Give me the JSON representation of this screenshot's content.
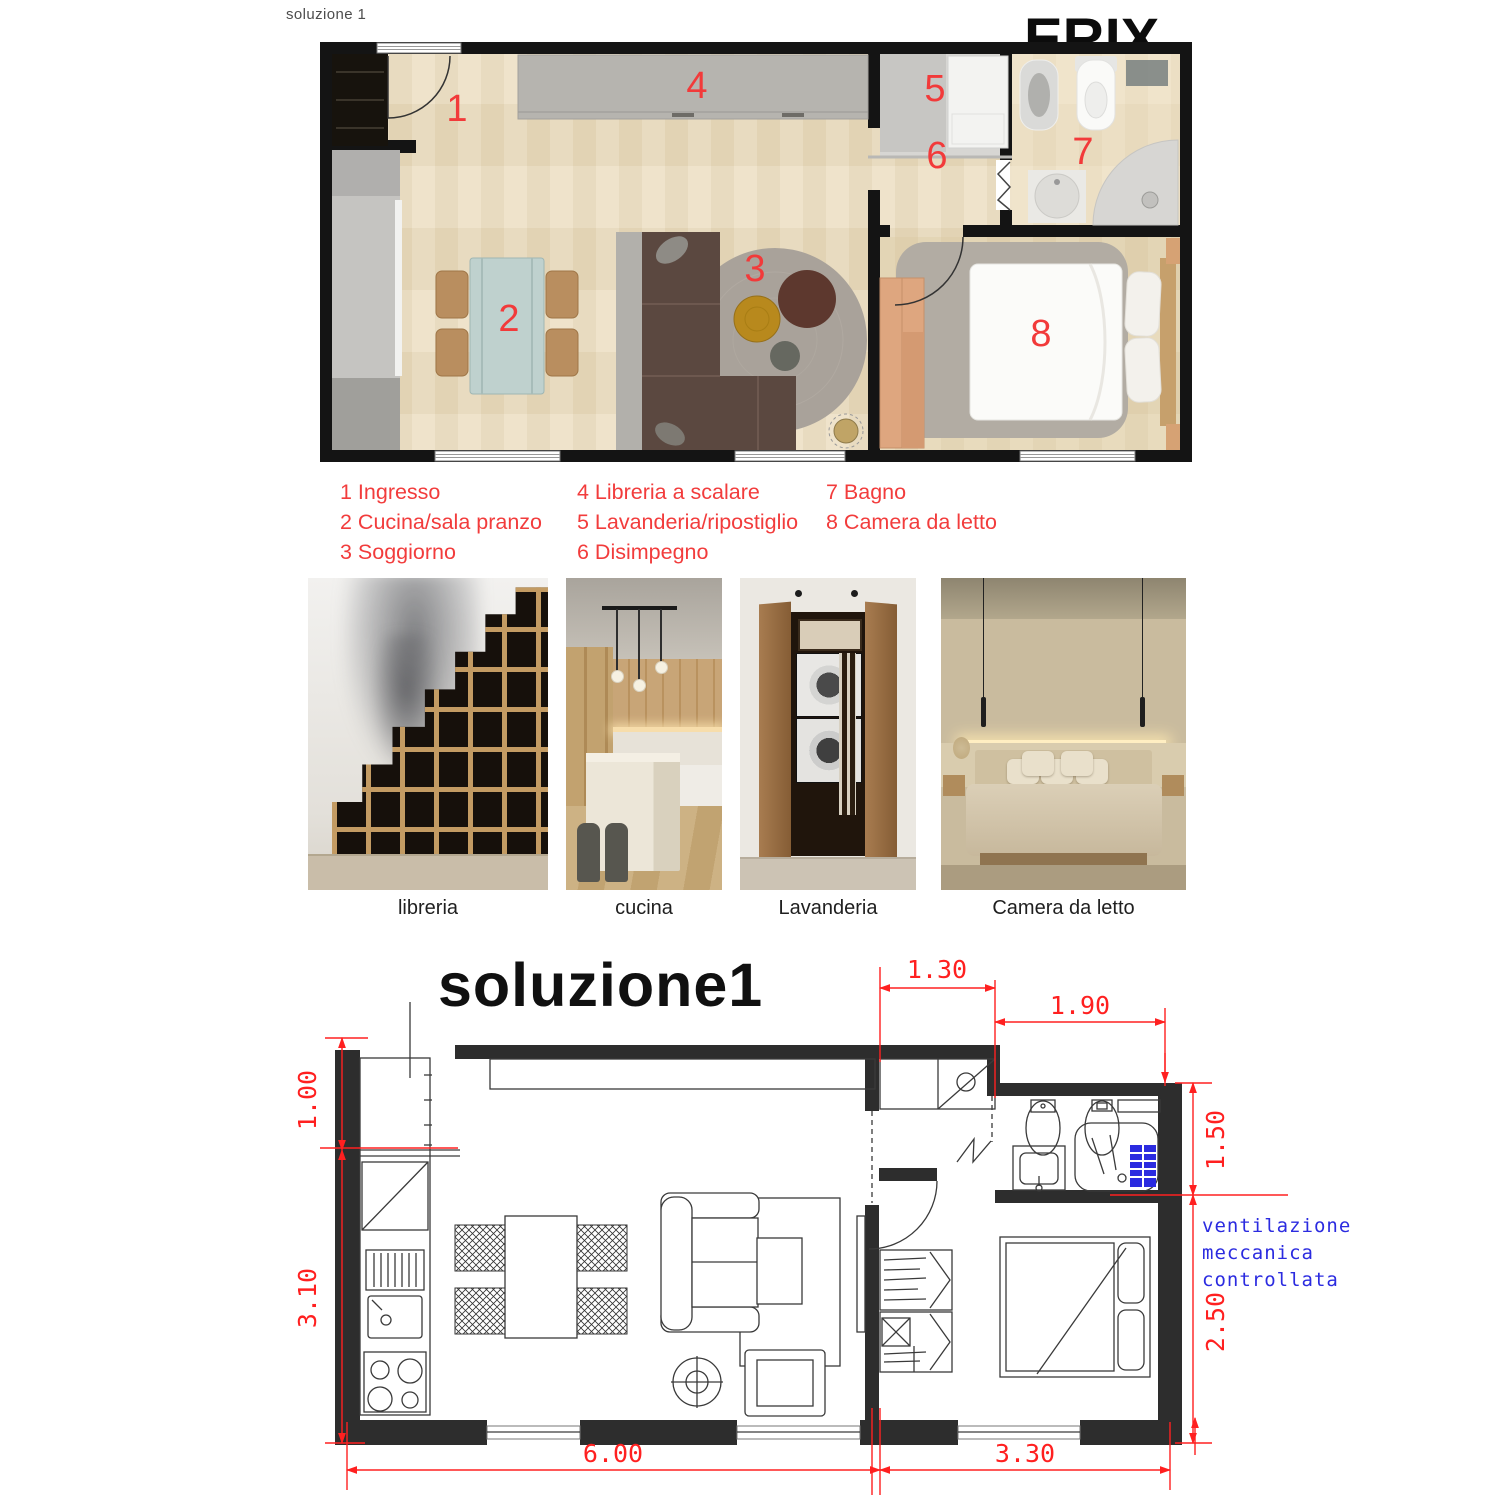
{
  "header": {
    "top_label": "soluzione 1",
    "brand": "ERIX"
  },
  "plan": {
    "numbers": [
      "1",
      "2",
      "3",
      "4",
      "5",
      "6",
      "7",
      "8"
    ]
  },
  "legend": {
    "columns": [
      {
        "items": [
          "1 Ingresso",
          "2 Cucina/sala pranzo",
          "3 Soggiorno"
        ]
      },
      {
        "items": [
          "4 Libreria a scalare",
          "5 Lavanderia/ripostiglio",
          "6 Disimpegno"
        ]
      },
      {
        "items": [
          "7 Bagno",
          "8 Camera da letto"
        ]
      }
    ]
  },
  "photos": [
    {
      "caption": "libreria"
    },
    {
      "caption": "cucina"
    },
    {
      "caption": "Lavanderia"
    },
    {
      "caption": "Camera da letto"
    }
  ],
  "cad": {
    "title": "soluzione1",
    "dims": {
      "laundry_width": "1.30",
      "bath_width": "1.90",
      "kitchen_top": "1.00",
      "kitchen_side": "3.10",
      "bath_side": "1.50",
      "bedroom_side": "2.50",
      "living_bottom": "6.00",
      "bedroom_bottom": "3.30"
    },
    "annotation": [
      "ventilazione",
      "meccanica",
      "controllata"
    ]
  },
  "colors": {
    "accent_red": "#f23a3a",
    "dim_red": "#ff2020",
    "annotation_blue": "#2b2be0"
  }
}
